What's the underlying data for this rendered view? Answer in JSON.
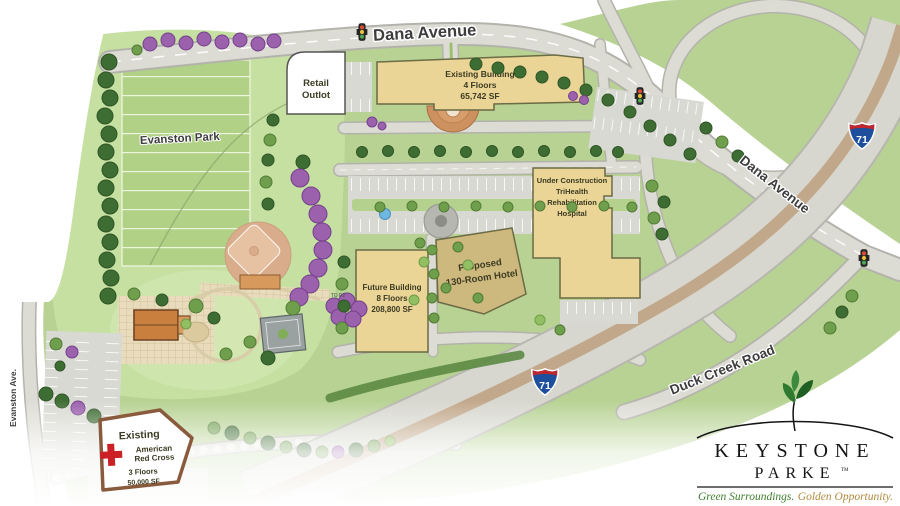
{
  "map": {
    "park_label": "Evanston Park",
    "roads": {
      "dana_avenue_top": "Dana Avenue",
      "dana_avenue_east": "Dana Avenue",
      "duck_creek_road": "Duck Creek Road",
      "evanston_ave": "Evanston Ave.",
      "to_p2_sign": "TO P2"
    },
    "highway": {
      "route_number": "71"
    },
    "buildings": {
      "retail_outlot": {
        "line1": "Retail",
        "line2": "Outlot"
      },
      "existing_building": {
        "line1": "Existing Building",
        "line2": "4 Floors",
        "line3": "65,742 SF"
      },
      "future_building": {
        "line1": "Future Building",
        "line2": "8 Floors",
        "line3": "208,800 SF"
      },
      "proposed_hotel": {
        "line1": "Proposed",
        "line2": "130-Room Hotel"
      },
      "trihealth_hospital": {
        "line1": "Under Construction",
        "line2": "TriHealth",
        "line3": "Rehabilitation",
        "line4": "Hospital"
      },
      "american_red_cross": {
        "line1": "Existing",
        "line2": "American",
        "line3": "Red Cross",
        "line4": "3 Floors",
        "line5": "50,000 SF"
      }
    }
  },
  "logo": {
    "name_top": "KEYSTONE",
    "name_bottom": "PARKE",
    "trademark": "TM",
    "tagline_green": "Green Surroundings.",
    "tagline_gold": "Golden Opportunity."
  },
  "icons": {
    "traffic_light": "traffic-light-icon",
    "interstate_shield": "interstate-71-shield-icon",
    "leaf": "leaf-icon",
    "red_cross": "red-cross-icon"
  },
  "colors": {
    "grass_green": "#b7d293",
    "park_green": "#c6e0a2",
    "road_gray": "#dddcd4",
    "highway_median_tan": "#c2a88b",
    "building_tan": "#ead596",
    "hotel_tan": "#cdb87e",
    "tree_purple": "#9b61ad",
    "shield_blue": "#1d4f9c",
    "shield_red": "#c0272d",
    "red_cross_red": "#cc2027",
    "logo_green": "#3f7d2e",
    "logo_gold": "#b0893c"
  }
}
